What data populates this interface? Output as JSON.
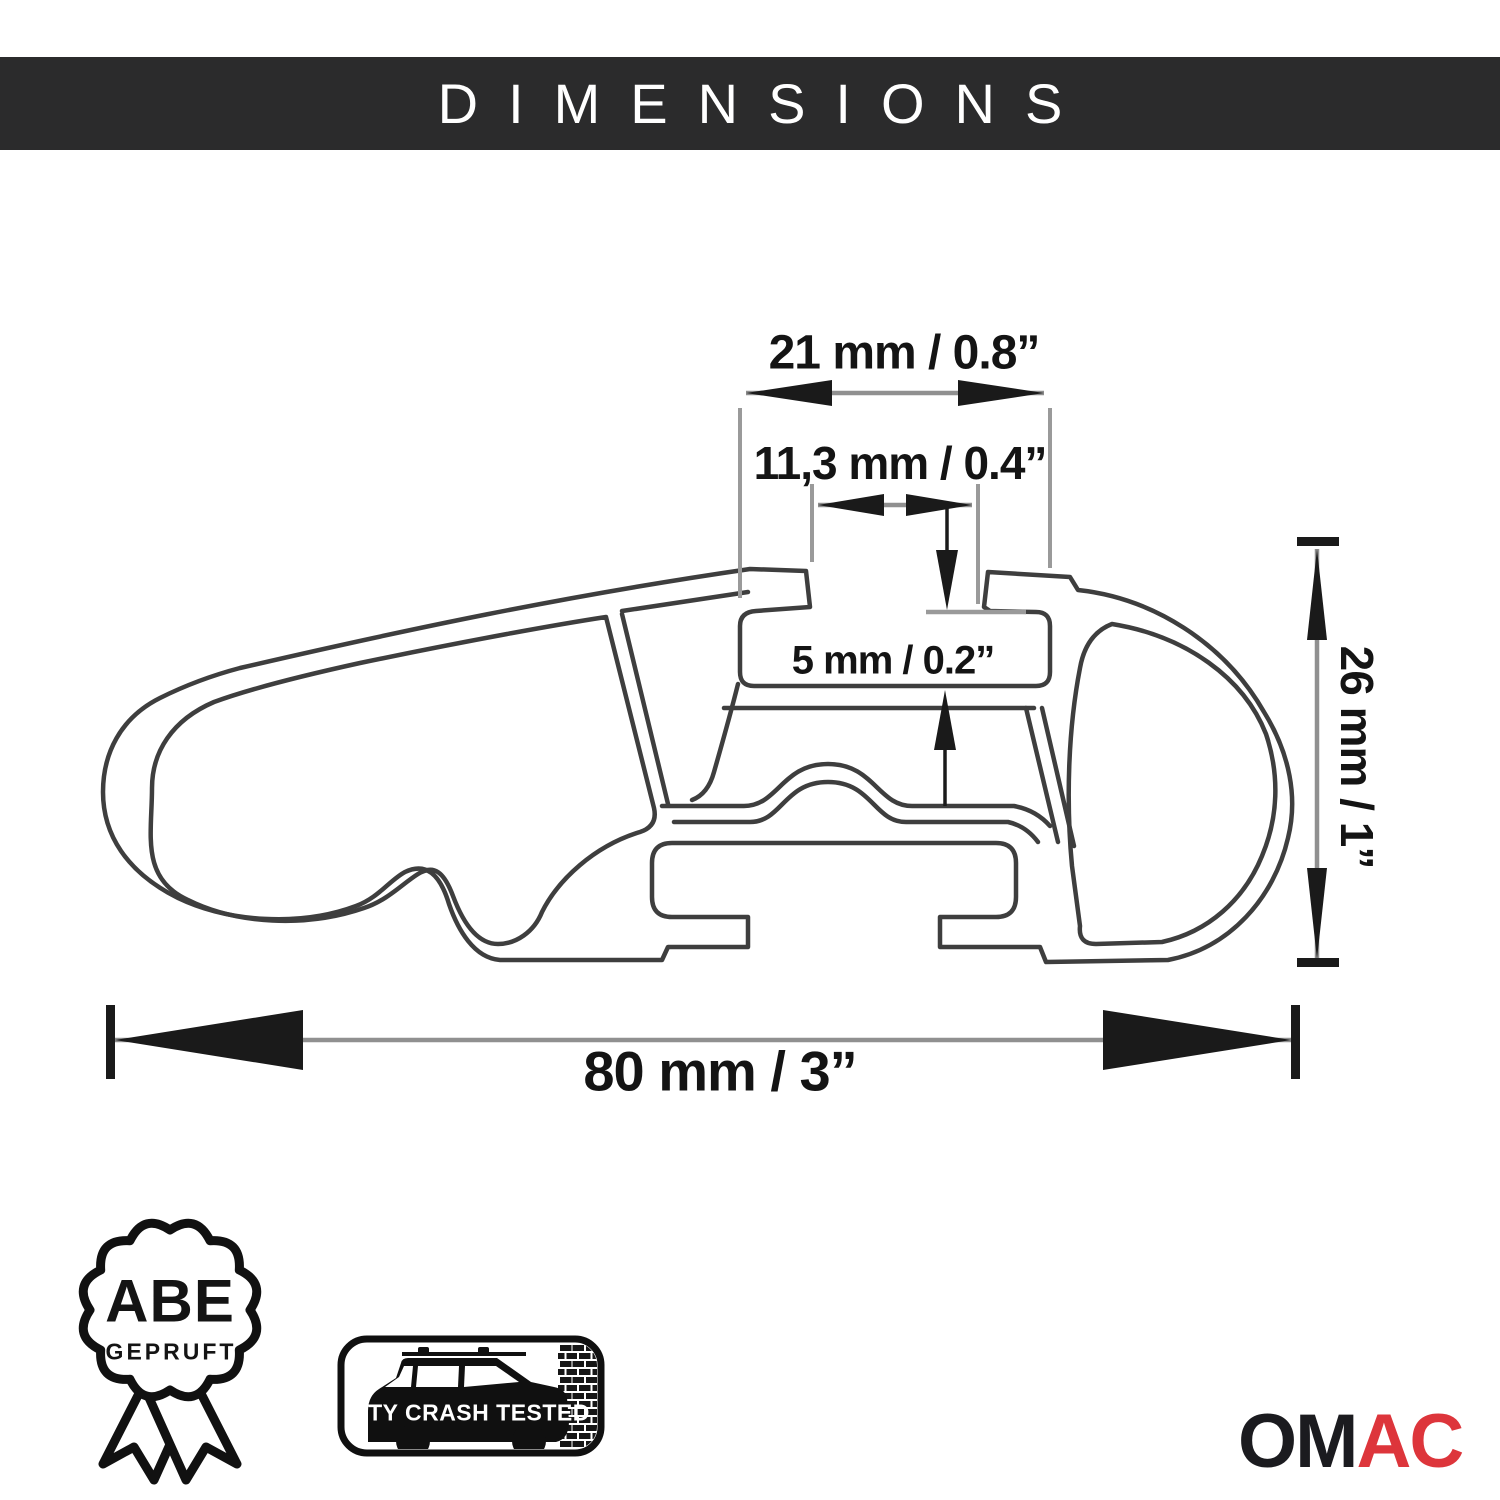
{
  "header": {
    "title": "DIMENSIONS"
  },
  "dimensions": [
    {
      "name": "channel-width",
      "label": "21 mm / 0.8”",
      "mm": 21,
      "inch": 0.8
    },
    {
      "name": "slot-opening-width",
      "label": "11,3 mm / 0.4”",
      "mm": 11.3,
      "inch": 0.4
    },
    {
      "name": "slot-depth",
      "label": "5 mm / 0.2”",
      "mm": 5,
      "inch": 0.2
    },
    {
      "name": "profile-height",
      "label": "26 mm / 1”",
      "mm": 26,
      "inch": 1
    },
    {
      "name": "profile-width",
      "label": "80 mm / 3”",
      "mm": 80,
      "inch": 3
    }
  ],
  "certifications": {
    "abe": {
      "title": "ABE",
      "subtitle": "GEPRUFT"
    },
    "city_crash": {
      "label": "CITY CRASH TESTED"
    }
  },
  "brand": {
    "name_black": "OM",
    "name_red": "AC"
  },
  "icons": [
    "abe-seal-icon",
    "city-crash-tested-car-icon"
  ],
  "colors": {
    "header_bg": "#2b2b2c",
    "header_text": "#ffffff",
    "profile_line": "#3e3e3e",
    "dimension_line": "#909090",
    "ink": "#141414",
    "brand_red": "#dd353b",
    "background": "#ffffff"
  }
}
